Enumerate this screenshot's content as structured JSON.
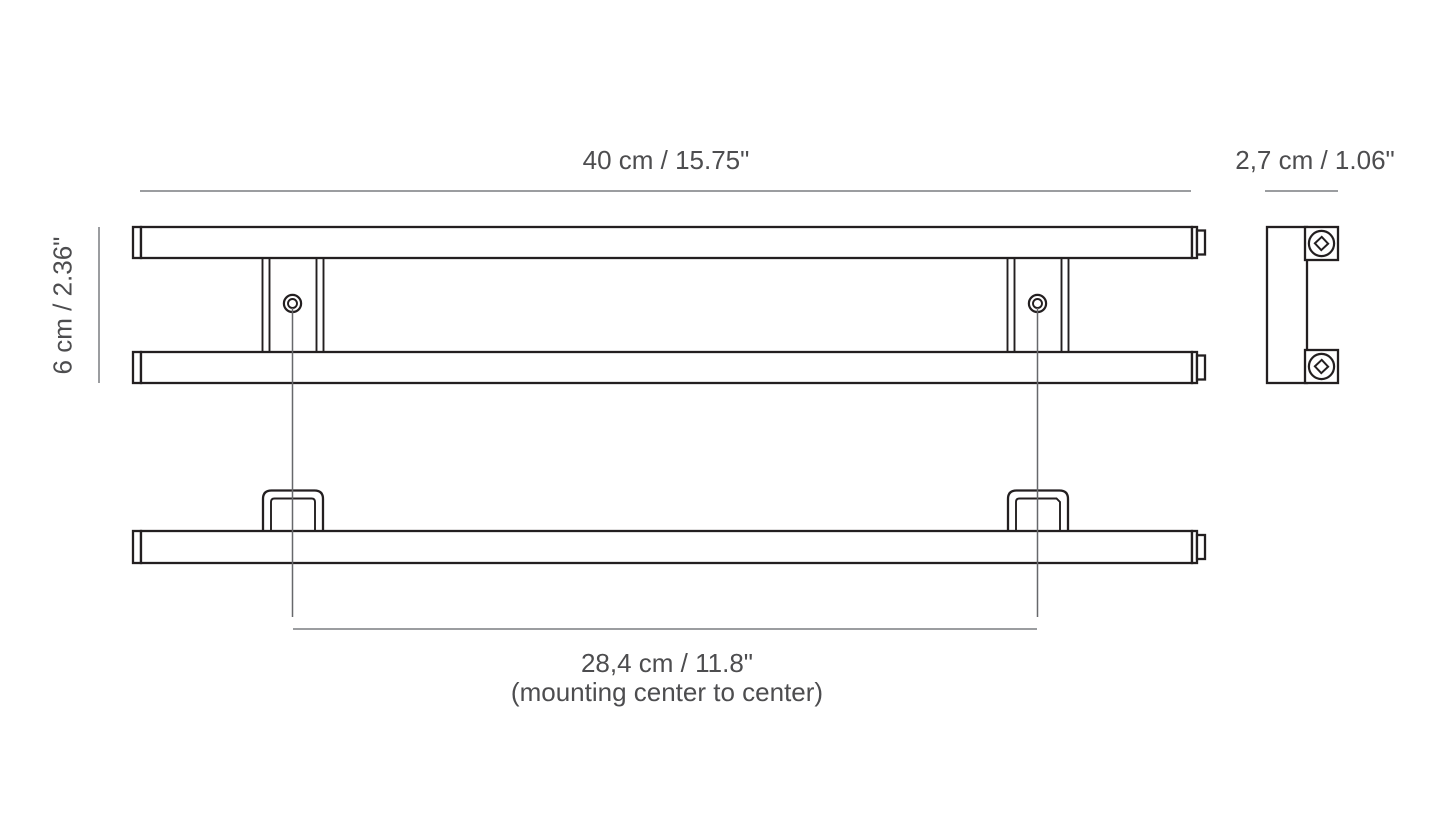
{
  "drawing": {
    "type": "technical-dimension-diagram",
    "subject": "double-bar wall rail with two mounting brackets",
    "views": [
      "front",
      "side",
      "bottom"
    ]
  },
  "labels": {
    "width": "40 cm / 15.75\"",
    "depth": "2,7 cm / 1.06\"",
    "height": "6 cm / 2.36\"",
    "mounting_distance": "28,4 cm / 11.8\"",
    "mounting_note": "(mounting center to center)"
  },
  "colors": {
    "background": "#ffffff",
    "outline": "#231f20",
    "dimension_line": "#9b9da0",
    "center_line": "#67686b",
    "text": "#4d4d4f"
  }
}
